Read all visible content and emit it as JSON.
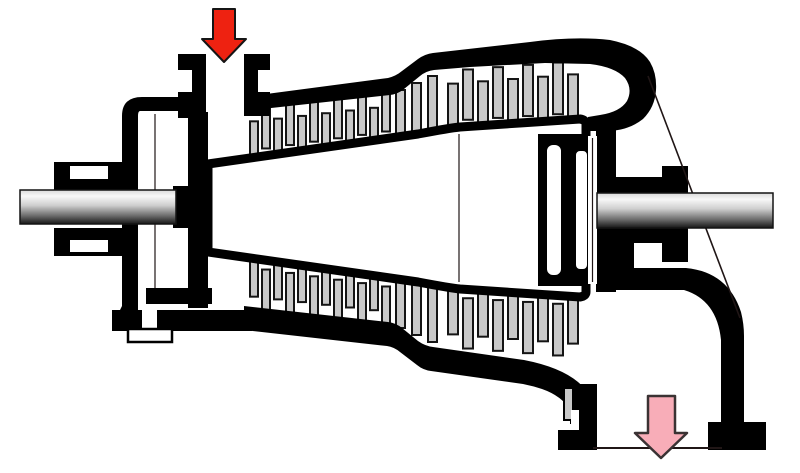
{
  "meta": {
    "title": "Axial steam turbine cross-section schematic",
    "type": "technical-diagram",
    "visible_text": []
  },
  "colors": {
    "background": "#ffffff",
    "casing": "#000000",
    "white": "#ffffff",
    "blade_fill": "#c8c8c8",
    "blade_stroke": "#141414",
    "inlet_arrow_fill": "#ee2211",
    "inlet_arrow_stroke": "#151515",
    "outlet_arrow_fill": "#f8adb8",
    "outlet_arrow_stroke": "#3a3233",
    "shaft_stroke": "#141414",
    "thin_line": "#201616"
  },
  "arrows": {
    "inlet": {
      "name": "inlet-flow-arrow",
      "direction": "down",
      "points": [
        [
          213,
          9
        ],
        [
          235,
          9
        ],
        [
          235,
          39
        ],
        [
          246,
          39
        ],
        [
          224,
          62
        ],
        [
          202,
          39
        ],
        [
          213,
          39
        ]
      ],
      "stroke_width": 2
    },
    "outlet": {
      "name": "outlet-flow-arrow",
      "direction": "down",
      "points": [
        [
          648,
          396
        ],
        [
          675,
          396
        ],
        [
          675,
          433
        ],
        [
          687,
          433
        ],
        [
          661,
          458
        ],
        [
          635,
          433
        ],
        [
          648,
          433
        ]
      ],
      "stroke_width": 2.5
    }
  },
  "shafts": [
    {
      "name": "left-shaft",
      "x": 20,
      "y": 190,
      "w": 156,
      "h": 34
    },
    {
      "name": "right-shaft",
      "x": 597,
      "y": 193,
      "w": 176,
      "h": 35
    }
  ],
  "blade_groups": [
    {
      "name": "top-left",
      "half": "top",
      "x0": 250,
      "pitch": 12,
      "count": 12,
      "width": 8,
      "casing_line": [
        248,
        113,
        390,
        97
      ],
      "drum_line": [
        248,
        158,
        418,
        134
      ]
    },
    {
      "name": "top-right",
      "half": "top",
      "x0": 448,
      "pitch": 15,
      "count": 9,
      "width": 10,
      "casing_line": [
        448,
        75,
        578,
        65
      ],
      "drum_line": [
        448,
        128,
        578,
        120
      ]
    },
    {
      "name": "bottom-left",
      "half": "bottom",
      "x0": 250,
      "pitch": 12,
      "count": 12,
      "width": 8,
      "casing_line": [
        248,
        305,
        390,
        321
      ],
      "drum_line": [
        248,
        260,
        418,
        284
      ]
    },
    {
      "name": "bottom-right",
      "half": "bottom",
      "x0": 448,
      "pitch": 15,
      "count": 9,
      "width": 10,
      "casing_line": [
        448,
        343,
        578,
        353
      ],
      "drum_line": [
        448,
        290,
        578,
        298
      ]
    }
  ],
  "step_blades": {
    "width": 9,
    "top": [
      [
        396,
        90,
        147
      ],
      [
        412,
        83,
        142
      ],
      [
        428,
        76,
        136
      ]
    ],
    "bottom": [
      [
        396,
        271,
        328
      ],
      [
        412,
        276,
        335
      ],
      [
        428,
        282,
        342
      ]
    ]
  },
  "lines": [
    {
      "name": "exhaust-cone-edge-line",
      "x1": 648,
      "y1": 76,
      "x2": 740,
      "y2": 318,
      "w": 1.6
    },
    {
      "name": "outlet-plane-line",
      "x1": 593,
      "y1": 448,
      "x2": 722,
      "y2": 448,
      "w": 2
    },
    {
      "name": "drum-joint-line",
      "x1": 459,
      "y1": 134,
      "x2": 459,
      "y2": 282,
      "w": 1.2
    },
    {
      "name": "gland-joint-line",
      "x1": 155,
      "y1": 114,
      "x2": 155,
      "y2": 288,
      "w": 1.2
    },
    {
      "name": "fin-joint-line",
      "x1": 592.5,
      "y1": 138,
      "x2": 592.5,
      "y2": 282,
      "w": 1.2
    }
  ]
}
